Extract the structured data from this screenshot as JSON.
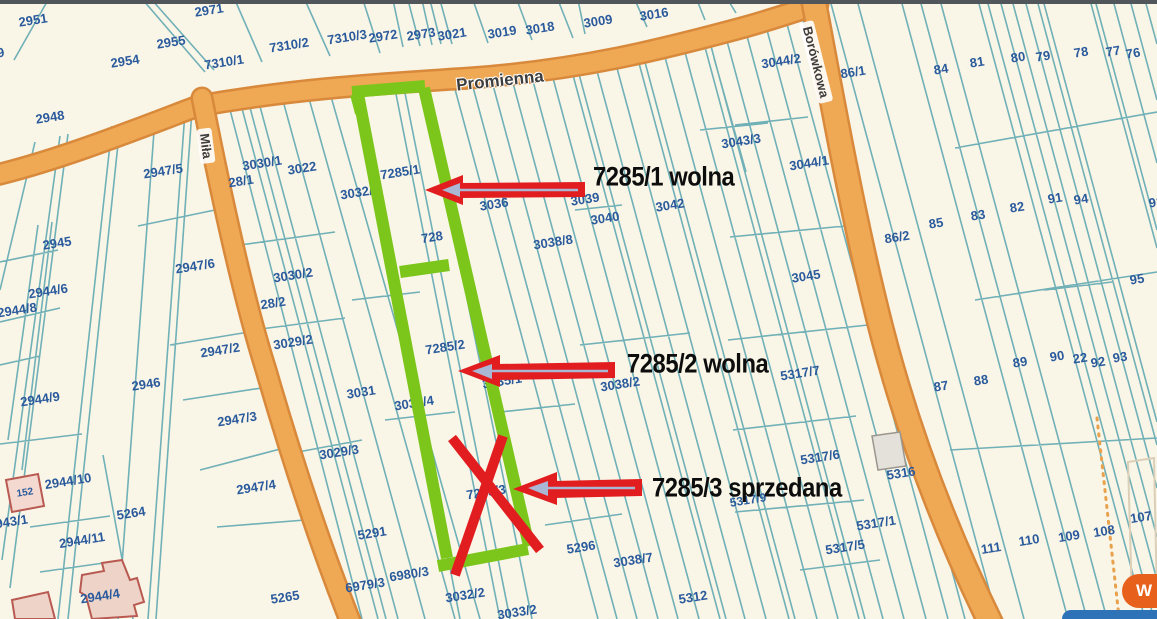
{
  "map": {
    "streets": [
      {
        "name": "Promienna",
        "x": 500,
        "y": 81,
        "rot": -6,
        "pill": false
      },
      {
        "name": "Miła",
        "x": 206,
        "y": 146,
        "rot": 83,
        "pill": true
      },
      {
        "name": "Borówkowa",
        "x": 816,
        "y": 62,
        "rot": 76,
        "pill": true
      }
    ],
    "parcel_labels": [
      {
        "t": "2951",
        "x": 33,
        "y": 20
      },
      {
        "t": "2971",
        "x": 209,
        "y": 10
      },
      {
        "t": "2955",
        "x": 171,
        "y": 42
      },
      {
        "t": "2954",
        "x": 125,
        "y": 61
      },
      {
        "t": "49",
        "x": -3,
        "y": 53
      },
      {
        "t": "2948",
        "x": 50,
        "y": 117
      },
      {
        "t": "7310/1",
        "x": 224,
        "y": 62
      },
      {
        "t": "7310/2",
        "x": 289,
        "y": 45
      },
      {
        "t": "7310/3",
        "x": 347,
        "y": 37
      },
      {
        "t": "2972",
        "x": 383,
        "y": 36
      },
      {
        "t": "2973",
        "x": 421,
        "y": 34
      },
      {
        "t": "3021",
        "x": 452,
        "y": 34
      },
      {
        "t": "3019",
        "x": 502,
        "y": 32
      },
      {
        "t": "3018",
        "x": 540,
        "y": 28
      },
      {
        "t": "3009",
        "x": 598,
        "y": 21
      },
      {
        "t": "3016",
        "x": 654,
        "y": 14
      },
      {
        "t": "3044/2",
        "x": 781,
        "y": 61
      },
      {
        "t": "86/1",
        "x": 853,
        "y": 72
      },
      {
        "t": "84",
        "x": 941,
        "y": 69
      },
      {
        "t": "81",
        "x": 977,
        "y": 62
      },
      {
        "t": "80",
        "x": 1018,
        "y": 57
      },
      {
        "t": "79",
        "x": 1043,
        "y": 56
      },
      {
        "t": "78",
        "x": 1081,
        "y": 52
      },
      {
        "t": "77",
        "x": 1113,
        "y": 51
      },
      {
        "t": "76",
        "x": 1133,
        "y": 53
      },
      {
        "t": "3043/3",
        "x": 741,
        "y": 141
      },
      {
        "t": "3044/1",
        "x": 809,
        "y": 163
      },
      {
        "t": "2947/5",
        "x": 163,
        "y": 171
      },
      {
        "t": "2945",
        "x": 57,
        "y": 243
      },
      {
        "t": "2947/6",
        "x": 195,
        "y": 266
      },
      {
        "t": "2944/6",
        "x": 48,
        "y": 291
      },
      {
        "t": "2944/8",
        "x": 17,
        "y": 310
      },
      {
        "t": "2944/9",
        "x": 40,
        "y": 399
      },
      {
        "t": "2946",
        "x": 146,
        "y": 384
      },
      {
        "t": "2947/2",
        "x": 220,
        "y": 350
      },
      {
        "t": "2947/3",
        "x": 237,
        "y": 419
      },
      {
        "t": "2944/10",
        "x": 68,
        "y": 481
      },
      {
        "t": "5264",
        "x": 131,
        "y": 513
      },
      {
        "t": "2943/1",
        "x": 8,
        "y": 522
      },
      {
        "t": "2944/11",
        "x": 82,
        "y": 540
      },
      {
        "t": "2944/4",
        "x": 100,
        "y": 596
      },
      {
        "t": "152",
        "x": 25,
        "y": 493,
        "s": 10
      },
      {
        "t": "5265",
        "x": 285,
        "y": 597
      },
      {
        "t": "2947/4",
        "x": 256,
        "y": 487
      },
      {
        "t": "28/1",
        "x": 241,
        "y": 181
      },
      {
        "t": "3030/1",
        "x": 262,
        "y": 163
      },
      {
        "t": "3022",
        "x": 302,
        "y": 168
      },
      {
        "t": "3032/5",
        "x": 360,
        "y": 192
      },
      {
        "t": "7285/1",
        "x": 400,
        "y": 172
      },
      {
        "t": "3030/2",
        "x": 293,
        "y": 275
      },
      {
        "t": "28/2",
        "x": 273,
        "y": 303
      },
      {
        "t": "3029/2",
        "x": 293,
        "y": 342
      },
      {
        "t": "728",
        "x": 432,
        "y": 237
      },
      {
        "t": "4",
        "x": 459,
        "y": 238
      },
      {
        "t": "3036",
        "x": 494,
        "y": 204
      },
      {
        "t": "3039",
        "x": 585,
        "y": 199
      },
      {
        "t": "3040",
        "x": 605,
        "y": 218
      },
      {
        "t": "3042",
        "x": 670,
        "y": 205
      },
      {
        "t": "3038/8",
        "x": 553,
        "y": 242
      },
      {
        "t": "3031",
        "x": 361,
        "y": 392
      },
      {
        "t": "3032/4",
        "x": 414,
        "y": 403
      },
      {
        "t": "7285/2",
        "x": 445,
        "y": 347
      },
      {
        "t": "3035/1",
        "x": 502,
        "y": 381
      },
      {
        "t": "3038/2",
        "x": 620,
        "y": 384
      },
      {
        "t": "3029/3",
        "x": 339,
        "y": 452
      },
      {
        "t": "5291",
        "x": 372,
        "y": 533
      },
      {
        "t": "6980/3",
        "x": 409,
        "y": 574
      },
      {
        "t": "6979/3",
        "x": 365,
        "y": 585
      },
      {
        "t": "3032/2",
        "x": 465,
        "y": 595
      },
      {
        "t": "3033/2",
        "x": 517,
        "y": 612
      },
      {
        "t": "5296",
        "x": 581,
        "y": 547
      },
      {
        "t": "3038/7",
        "x": 633,
        "y": 560
      },
      {
        "t": "5312",
        "x": 693,
        "y": 597
      },
      {
        "t": "7285/3",
        "x": 486,
        "y": 492
      },
      {
        "t": "86/2",
        "x": 897,
        "y": 237
      },
      {
        "t": "85",
        "x": 936,
        "y": 223
      },
      {
        "t": "83",
        "x": 978,
        "y": 215
      },
      {
        "t": "82",
        "x": 1017,
        "y": 207
      },
      {
        "t": "91",
        "x": 1055,
        "y": 198
      },
      {
        "t": "94",
        "x": 1081,
        "y": 199
      },
      {
        "t": "91",
        "x": 1156,
        "y": 202
      },
      {
        "t": "95",
        "x": 1137,
        "y": 279
      },
      {
        "t": "3045",
        "x": 806,
        "y": 276
      },
      {
        "t": "5317/7",
        "x": 800,
        "y": 373
      },
      {
        "t": "87",
        "x": 941,
        "y": 386
      },
      {
        "t": "88",
        "x": 981,
        "y": 380
      },
      {
        "t": "89",
        "x": 1020,
        "y": 362
      },
      {
        "t": "90",
        "x": 1057,
        "y": 356
      },
      {
        "t": "22",
        "x": 1080,
        "y": 358
      },
      {
        "t": "92",
        "x": 1098,
        "y": 362
      },
      {
        "t": "93",
        "x": 1120,
        "y": 357
      },
      {
        "t": "5317/6",
        "x": 820,
        "y": 457
      },
      {
        "t": "5316",
        "x": 901,
        "y": 473
      },
      {
        "t": "5317/9",
        "x": 748,
        "y": 500,
        "s": 12
      },
      {
        "t": "5317/1",
        "x": 876,
        "y": 523
      },
      {
        "t": "5317/5",
        "x": 845,
        "y": 547
      },
      {
        "t": "111",
        "x": 991,
        "y": 548
      },
      {
        "t": "110",
        "x": 1029,
        "y": 540
      },
      {
        "t": "109",
        "x": 1069,
        "y": 536
      },
      {
        "t": "108",
        "x": 1104,
        "y": 531
      },
      {
        "t": "107",
        "x": 1141,
        "y": 517
      }
    ]
  },
  "annotations": [
    {
      "text": "7285/1 wolna",
      "x": 593,
      "y": 177
    },
    {
      "text": "7285/2 wolna",
      "x": 627,
      "y": 364
    },
    {
      "text": "7285/3 sprzedana",
      "x": 652,
      "y": 488
    }
  ],
  "widget": {
    "chat_label": "W"
  },
  "colors": {
    "background": "#f9f5e7",
    "parcel_line": "#68acb4",
    "label_blue": "#2a5a9c",
    "road_fill": "#efa854",
    "road_edge": "#d8893b",
    "highlight_green": "#7cc61b",
    "annotation_red": "#e21d1f",
    "chat_orange": "#e8611c",
    "bottom_bar_blue": "#2e72b7"
  }
}
